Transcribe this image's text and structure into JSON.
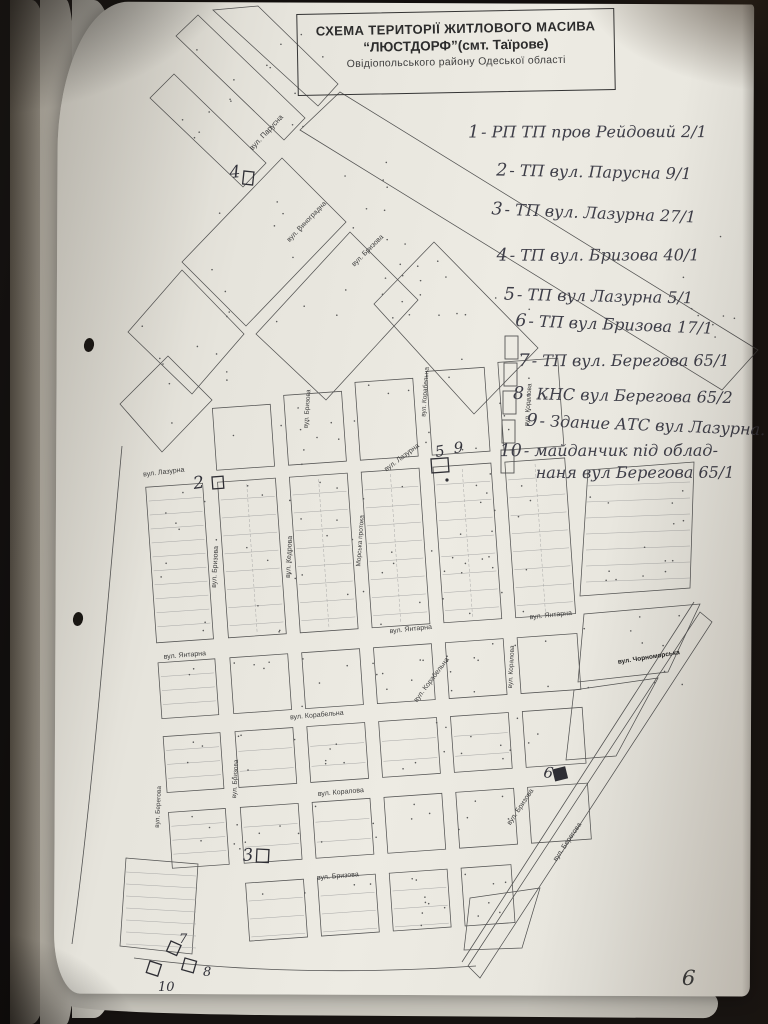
{
  "colors": {
    "page": "#eae8e0",
    "map_ink": "#474747",
    "pen_ink": "#3e3e48",
    "backdrop": "#161210"
  },
  "title_box": {
    "line1": "СХЕМА ТЕРИТОРІЇ ЖИТЛОВОГО МАСИВА",
    "line2": "“ЛЮСТДОРФ”(смт. Таїрове)",
    "line3": "Овідіопольського району  Одеської області"
  },
  "legend": {
    "items": [
      {
        "num": "1",
        "text": "- РП ТП  пров Рейдовий  2/1"
      },
      {
        "num": "2",
        "text": "- ТП вул. Парусна  9/1"
      },
      {
        "num": "3",
        "text": "- ТП вул. Лазурна  27/1"
      },
      {
        "num": "4",
        "text": "- ТП вул. Бризова  40/1"
      },
      {
        "num": "5",
        "text": "- ТП вул Лазурна  5/1"
      },
      {
        "num": "6",
        "text": "- ТП вул Бризова  17/1"
      },
      {
        "num": "7",
        "text": "- ТП вул. Берегова  65/1"
      },
      {
        "num": "8",
        "text": "- КНС вул Берегова  65/2"
      },
      {
        "num": "9",
        "text": "- Здание АТС вул Лазурна."
      },
      {
        "num": "10",
        "text": "- майданчик під облад-",
        "text2": "наня  вул Берегова 65/1"
      }
    ]
  },
  "map": {
    "page_number": "6",
    "street_labels": [
      {
        "text": "вул. Парусна",
        "x": 268,
        "y": 134,
        "r": -47,
        "fs": 7.5
      },
      {
        "text": "вул. Виноградна",
        "x": 308,
        "y": 223,
        "r": -46,
        "fs": 7
      },
      {
        "text": "вул. Бризова",
        "x": 369,
        "y": 252,
        "r": -45,
        "fs": 7
      },
      {
        "text": "вул. Лазурна",
        "x": 164,
        "y": 474,
        "r": -7,
        "fs": 7
      },
      {
        "text": "вул. Лазурна",
        "x": 403,
        "y": 459,
        "r": -37,
        "fs": 7
      },
      {
        "text": "вул. Бризова",
        "x": 309,
        "y": 409,
        "r": -86,
        "fs": 6.5
      },
      {
        "text": "вул. Корабельна",
        "x": 427,
        "y": 392,
        "r": -86,
        "fs": 6.5
      },
      {
        "text": "вул. Коралова",
        "x": 530,
        "y": 405,
        "r": -86,
        "fs": 6.5
      },
      {
        "text": "вул. Бризова",
        "x": 217,
        "y": 567,
        "r": -87,
        "fs": 7
      },
      {
        "text": "вул. Кедрова",
        "x": 291,
        "y": 557,
        "r": -87,
        "fs": 7
      },
      {
        "text": "Морська протока",
        "x": 362,
        "y": 541,
        "r": -86,
        "fs": 6.5
      },
      {
        "text": "вул. Янтарна",
        "x": 185,
        "y": 657,
        "r": -5,
        "fs": 7
      },
      {
        "text": "вул. Янтарна",
        "x": 411,
        "y": 631,
        "r": -6,
        "fs": 7
      },
      {
        "text": "вул. Янтарна",
        "x": 551,
        "y": 617,
        "r": -6,
        "fs": 7
      },
      {
        "text": "вул. Чорноморська",
        "x": 649,
        "y": 659,
        "r": -9,
        "fs": 6.5,
        "b": 1
      },
      {
        "text": "вул. Корабельна",
        "x": 433,
        "y": 681,
        "r": -53,
        "fs": 7
      },
      {
        "text": "вул. Корабельна",
        "x": 317,
        "y": 717,
        "r": -5,
        "fs": 7
      },
      {
        "text": "вул. Коралова",
        "x": 513,
        "y": 667,
        "r": -87,
        "fs": 6.5
      },
      {
        "text": "вул. Коралова",
        "x": 341,
        "y": 794,
        "r": -5,
        "fs": 7
      },
      {
        "text": "вул. Бризова",
        "x": 237,
        "y": 779,
        "r": -87,
        "fs": 6.5
      },
      {
        "text": "вул. Берегова",
        "x": 160,
        "y": 807,
        "r": -87,
        "fs": 6.5
      },
      {
        "text": "вул. Бризова",
        "x": 338,
        "y": 878,
        "r": -5,
        "fs": 7
      },
      {
        "text": "вул. Бризова",
        "x": 522,
        "y": 808,
        "r": -56,
        "fs": 7
      },
      {
        "text": "вул. Берегова",
        "x": 569,
        "y": 843,
        "r": -56,
        "fs": 7
      }
    ],
    "markers": [
      {
        "label": "4",
        "x": 230,
        "y": 178,
        "fs": 17,
        "r": -5
      },
      {
        "label": "2",
        "x": 194,
        "y": 489,
        "fs": 17,
        "r": -8
      },
      {
        "label": "5",
        "x": 436,
        "y": 457,
        "fs": 15,
        "r": -10
      },
      {
        "label": "9",
        "x": 454,
        "y": 453,
        "fs": 15,
        "r": -4
      },
      {
        "label": "3",
        "x": 243,
        "y": 861,
        "fs": 17,
        "r": -5
      },
      {
        "label": "6",
        "x": 543,
        "y": 777,
        "fs": 15,
        "r": 8
      },
      {
        "label": "7",
        "x": 179,
        "y": 943,
        "fs": 13,
        "r": 0
      },
      {
        "label": "10",
        "x": 158,
        "y": 991,
        "fs": 13,
        "r": 0
      },
      {
        "label": "8",
        "x": 203,
        "y": 976,
        "fs": 13,
        "r": 0
      }
    ],
    "marker_squares": [
      {
        "x": 244,
        "y": 171,
        "w": 10,
        "h": 13,
        "r": 6,
        "fill": 0
      },
      {
        "x": 212,
        "y": 477,
        "w": 11,
        "h": 12,
        "r": -4,
        "fill": 0
      },
      {
        "x": 431,
        "y": 459,
        "w": 17,
        "h": 14,
        "r": -4,
        "fill": 0
      },
      {
        "x": 257,
        "y": 849,
        "w": 12,
        "h": 13,
        "r": 3,
        "fill": 0
      },
      {
        "x": 553,
        "y": 770,
        "w": 12,
        "h": 11,
        "r": -14,
        "fill": 1
      },
      {
        "x": 150,
        "y": 961,
        "w": 12,
        "h": 12,
        "r": 18,
        "fill": 0
      },
      {
        "x": 171,
        "y": 941,
        "w": 11,
        "h": 11,
        "r": 24,
        "fill": 0
      },
      {
        "x": 185,
        "y": 958,
        "w": 12,
        "h": 12,
        "r": 16,
        "fill": 0
      }
    ]
  }
}
